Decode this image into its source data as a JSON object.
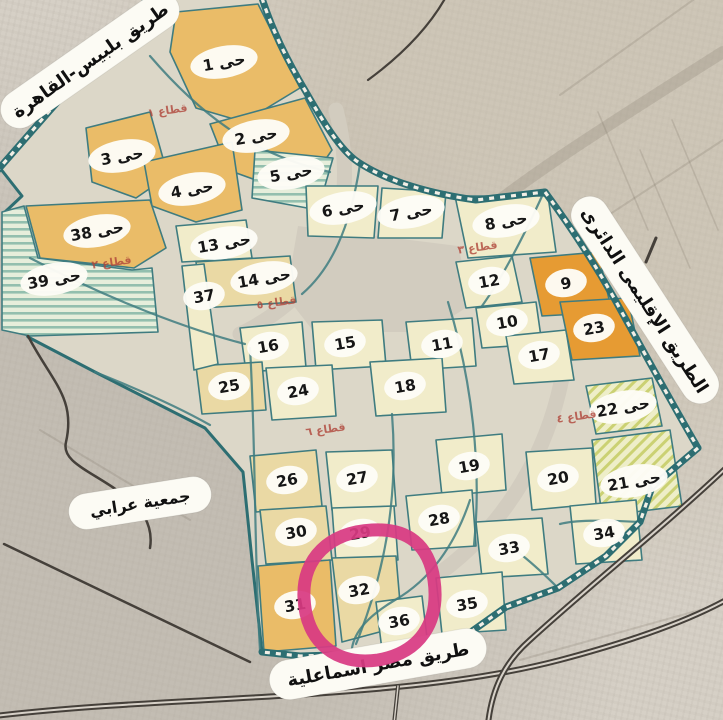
{
  "palette": {
    "desert": "#d6d0c6",
    "city_base": "#dcd7c8",
    "district_orange": "#eabc68",
    "district_deep_orange": "#e69b33",
    "district_tan": "#ead9a4",
    "district_cream": "#f1ecca",
    "hatch_teal": "#93bfae",
    "hatch_yellow": "#cbd173",
    "road_teal": "#2d6e72",
    "annotation_pink": "#d83a82",
    "sector_red": "#b0463a"
  },
  "road_labels": [
    {
      "name": "belbeis-cairo-road",
      "text": "طريق بلبيس-القاهرة"
    },
    {
      "name": "regional-ring-road",
      "text": "الطريق الإقليمى الدائرى"
    },
    {
      "name": "cairo-ismailia-road",
      "text": "طريق مصر اسماعلية"
    }
  ],
  "area_labels": [
    {
      "name": "orabi-association",
      "text": "جمعية عرابي"
    }
  ],
  "annotation": {
    "shape": "hand-drawn-circle",
    "around_district": "32",
    "color": "#d83a82"
  },
  "sector_labels": [
    {
      "text": "قطاع ١",
      "x": 168,
      "y": 114
    },
    {
      "text": "قطاع ٢",
      "x": 112,
      "y": 266
    },
    {
      "text": "قطاع ٣",
      "x": 478,
      "y": 251
    },
    {
      "text": "قطاع ٥",
      "x": 277,
      "y": 306
    },
    {
      "text": "قطاع ٦",
      "x": 326,
      "y": 433
    },
    {
      "text": "قطاع ٤",
      "x": 577,
      "y": 420
    }
  ],
  "districts": [
    {
      "label": "حى 1",
      "x": 224,
      "y": 62,
      "tone": "orange"
    },
    {
      "label": "حى 2",
      "x": 256,
      "y": 136,
      "tone": "orange"
    },
    {
      "label": "حى 3",
      "x": 122,
      "y": 156,
      "tone": "orange"
    },
    {
      "label": "حى 4",
      "x": 192,
      "y": 189,
      "tone": "orange"
    },
    {
      "label": "حى 5",
      "x": 291,
      "y": 173,
      "tone": "hatch-teal"
    },
    {
      "label": "حى 6",
      "x": 343,
      "y": 208,
      "tone": "cream"
    },
    {
      "label": "حى 7",
      "x": 411,
      "y": 212,
      "tone": "cream"
    },
    {
      "label": "حى 8",
      "x": 506,
      "y": 221,
      "tone": "cream"
    },
    {
      "label": "9",
      "x": 566,
      "y": 283,
      "tone": "deep-orange"
    },
    {
      "label": "10",
      "x": 507,
      "y": 322,
      "tone": "cream"
    },
    {
      "label": "11",
      "x": 442,
      "y": 344,
      "tone": "cream"
    },
    {
      "label": "12",
      "x": 489,
      "y": 281,
      "tone": "cream"
    },
    {
      "label": "حى 13",
      "x": 224,
      "y": 243,
      "tone": "cream"
    },
    {
      "label": "حى 14",
      "x": 264,
      "y": 278,
      "tone": "tan"
    },
    {
      "label": "15",
      "x": 345,
      "y": 343,
      "tone": "cream"
    },
    {
      "label": "16",
      "x": 268,
      "y": 346,
      "tone": "cream"
    },
    {
      "label": "17",
      "x": 539,
      "y": 355,
      "tone": "cream"
    },
    {
      "label": "18",
      "x": 405,
      "y": 386,
      "tone": "cream"
    },
    {
      "label": "19",
      "x": 469,
      "y": 466,
      "tone": "cream"
    },
    {
      "label": "20",
      "x": 558,
      "y": 478,
      "tone": "cream"
    },
    {
      "label": "حى 21",
      "x": 634,
      "y": 481,
      "tone": "hatch-yellow"
    },
    {
      "label": "حى 22",
      "x": 623,
      "y": 407,
      "tone": "hatch-yellow"
    },
    {
      "label": "23",
      "x": 594,
      "y": 328,
      "tone": "deep-orange"
    },
    {
      "label": "24",
      "x": 298,
      "y": 391,
      "tone": "cream"
    },
    {
      "label": "25",
      "x": 229,
      "y": 386,
      "tone": "tan"
    },
    {
      "label": "26",
      "x": 287,
      "y": 480,
      "tone": "tan"
    },
    {
      "label": "27",
      "x": 357,
      "y": 478,
      "tone": "cream"
    },
    {
      "label": "28",
      "x": 439,
      "y": 519,
      "tone": "cream"
    },
    {
      "label": "29",
      "x": 360,
      "y": 533,
      "tone": "cream"
    },
    {
      "label": "30",
      "x": 296,
      "y": 532,
      "tone": "tan"
    },
    {
      "label": "31",
      "x": 295,
      "y": 605,
      "tone": "orange"
    },
    {
      "label": "32",
      "x": 359,
      "y": 590,
      "tone": "tan"
    },
    {
      "label": "33",
      "x": 509,
      "y": 548,
      "tone": "cream"
    },
    {
      "label": "34",
      "x": 604,
      "y": 533,
      "tone": "cream"
    },
    {
      "label": "35",
      "x": 467,
      "y": 604,
      "tone": "cream"
    },
    {
      "label": "36",
      "x": 399,
      "y": 621,
      "tone": "cream"
    },
    {
      "label": "37",
      "x": 204,
      "y": 296,
      "tone": "cream"
    },
    {
      "label": "حى 38",
      "x": 97,
      "y": 231,
      "tone": "orange"
    },
    {
      "label": "حى 39",
      "x": 54,
      "y": 279,
      "tone": "hatch-teal"
    }
  ]
}
